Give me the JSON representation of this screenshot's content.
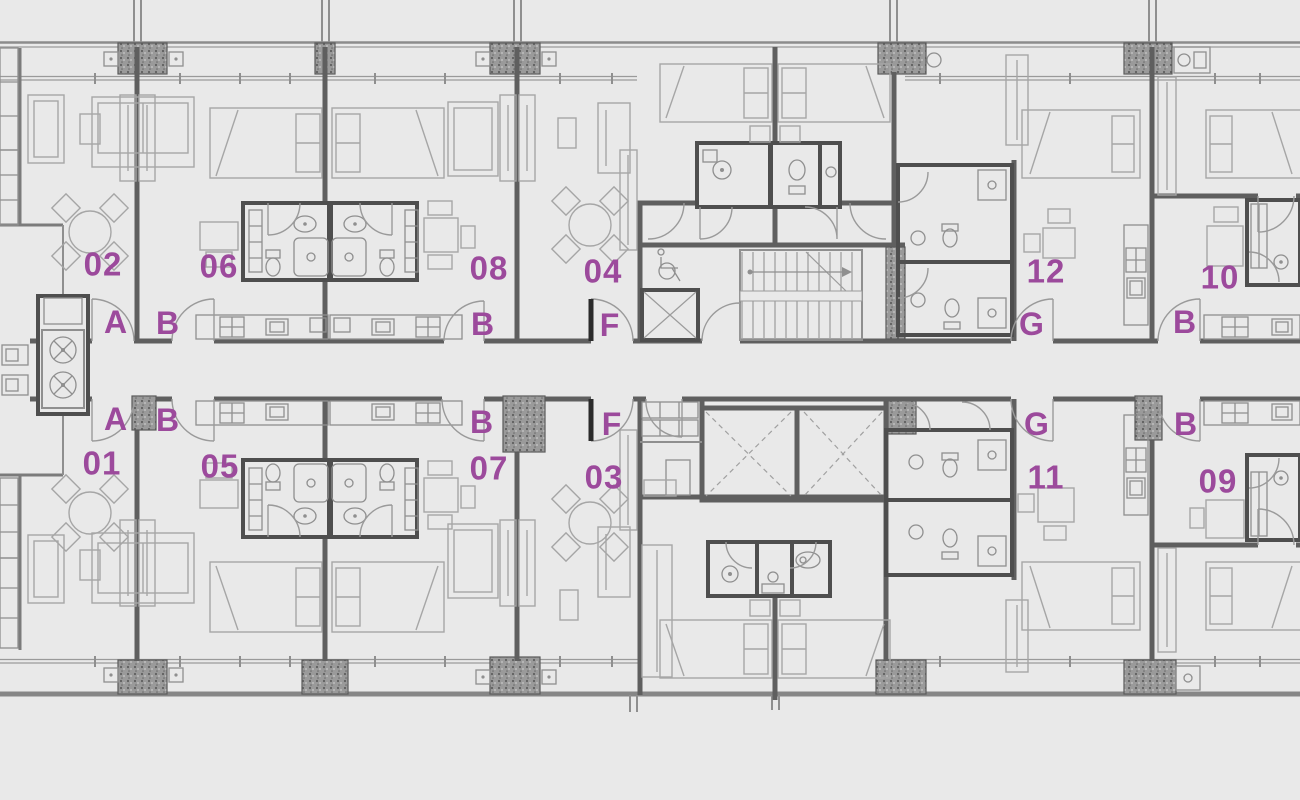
{
  "page": {
    "background": "#e9e9e9",
    "wall_color": "#5f5f5f",
    "label_color": "#9c4a9c"
  },
  "labels": {
    "u01": "01",
    "u02": "02",
    "u03": "03",
    "u04": "04",
    "u05": "05",
    "u06": "06",
    "u07": "07",
    "u08": "08",
    "u09": "09",
    "u10": "10",
    "u11": "11",
    "u12": "12",
    "door_a_top": "A",
    "door_b1_top": "B",
    "door_b2_top": "B",
    "door_f_top": "F",
    "door_g_top": "G",
    "door_b3_top": "B",
    "door_a_bot": "A",
    "door_b1_bot": "B",
    "door_b2_bot": "B",
    "door_f_bot": "F",
    "door_g_bot": "G",
    "door_b3_bot": "B"
  }
}
